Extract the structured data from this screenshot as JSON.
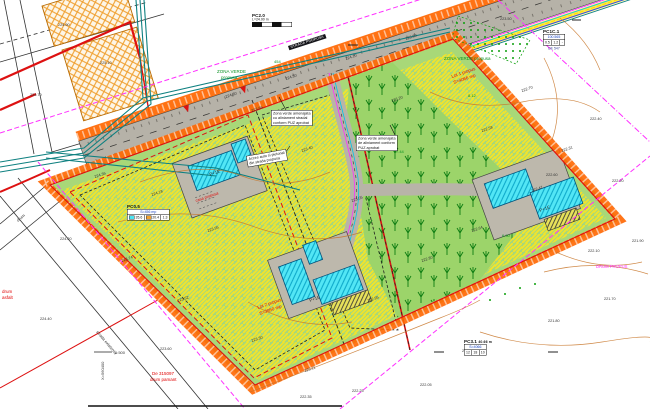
{
  "title": "Plan de situatie - propunere",
  "colors": {
    "red": "#e00000",
    "grn": "#089020",
    "blk": "#333333",
    "mag": "#ff30ff",
    "boundary_band": "#ff6600",
    "red_line": "#dd1111",
    "parcel_green": "#a8d878",
    "hatch_yellow": "#f2e42a",
    "building_cyan": "#52e6f5",
    "pad_gray": "#bdb8ac",
    "road_gray": "#b6b2a8",
    "existing_hatch": "#f0a030",
    "utility_teal": "#0e8080",
    "contour": "#c8762a",
    "tree_green": "#0e7d12"
  },
  "scale_tables": {
    "pc2": {
      "title": "PC2.0",
      "sub": "L=24.00 m"
    },
    "pc1c": {
      "title": "PC1C.1",
      "header": "100.565",
      "cells": [
        "0.5",
        "1.2",
        "-"
      ],
      "note": "DE 547"
    },
    "pc05": {
      "title": "PC0.5",
      "header": "S=456 mp",
      "cells": [
        "35.6",
        "20.4",
        "1.3"
      ]
    },
    "pc3": {
      "title": "PC3.1",
      "sub": "40.66 m",
      "header": "S=4066",
      "cells": [
        "12",
        "18",
        "10"
      ]
    }
  },
  "annotation_boxes": {
    "b1": {
      "lines": [
        "Zona verde amenajata",
        "cu aliniament stradal",
        "conform PUZ aprobat"
      ]
    },
    "b2": {
      "lines": [
        "Acces auto si pietonal",
        "din strada propusa"
      ]
    },
    "b3": {
      "lines": [
        "Zona verde amenajata",
        "de aliniament conform",
        "PUZ aprobat"
      ]
    },
    "street_tag": "STRADA PROPUSA"
  },
  "labels": [
    {
      "t": "Lot 1 propus",
      "x": 452,
      "y": 78,
      "c": "red",
      "r": -19
    },
    {
      "t": "S=4066 mp",
      "x": 454,
      "y": 84,
      "c": "red",
      "r": -19
    },
    {
      "t": "Lot 2 propus",
      "x": 258,
      "y": 309,
      "c": "red",
      "r": -19
    },
    {
      "t": "S=3950 mp",
      "x": 260,
      "y": 315,
      "c": "red",
      "r": -19
    },
    {
      "t": "casa propusa",
      "x": 196,
      "y": 202,
      "c": "red",
      "r": -19,
      "s": 4
    },
    {
      "t": "De 315097",
      "x": 152,
      "y": 375,
      "c": "red"
    },
    {
      "t": "drum pamant",
      "x": 150,
      "y": 381,
      "c": "red"
    },
    {
      "t": "drum",
      "x": 2,
      "y": 293,
      "c": "red"
    },
    {
      "t": "asfalt",
      "x": 2,
      "y": 299,
      "c": "red"
    },
    {
      "t": "DRUM PROPUS",
      "x": 596,
      "y": 268,
      "c": "mag",
      "s": 4.2
    },
    {
      "t": "ZONA VERDE",
      "x": 217,
      "y": 73,
      "c": "grn"
    },
    {
      "t": "propusa",
      "x": 221,
      "y": 79,
      "c": "grn"
    },
    {
      "t": "ZONA VERDE propusa",
      "x": 444,
      "y": 60,
      "c": "grn"
    },
    {
      "t": "454",
      "x": 274,
      "y": 63,
      "c": "grn",
      "s": 4
    },
    {
      "t": "7.44",
      "x": 396,
      "y": 153,
      "c": "grn",
      "s": 4
    },
    {
      "t": "8.12",
      "x": 468,
      "y": 97,
      "c": "grn",
      "s": 4
    },
    {
      "t": "6.90",
      "x": 502,
      "y": 237,
      "c": "grn",
      "s": 4
    },
    {
      "t": "P+1E",
      "x": 210,
      "y": 176,
      "c": "blk",
      "r": -20
    },
    {
      "t": "P+1E",
      "x": 310,
      "y": 302,
      "c": "blk",
      "r": -20
    },
    {
      "t": "P+1E",
      "x": 540,
      "y": 212,
      "c": "blk",
      "r": -20
    },
    {
      "t": "strada existenta",
      "x": 96,
      "y": 332,
      "c": "blk",
      "r": 50,
      "s": 4.2
    },
    {
      "t": "drum",
      "x": 18,
      "y": 222,
      "c": "blk",
      "r": -40,
      "s": 4.2
    },
    {
      "t": "X=560400",
      "x": 104,
      "y": 380,
      "c": "blk",
      "r": -90,
      "s": 4
    },
    {
      "t": "1:500",
      "x": 115,
      "y": 354,
      "c": "blk",
      "s": 4
    },
    {
      "t": "224.36",
      "x": 95,
      "y": 178,
      "c": "blk",
      "s": 3.8,
      "r": -19
    },
    {
      "t": "224.18",
      "x": 152,
      "y": 196,
      "c": "blk",
      "s": 3.8,
      "r": -19
    },
    {
      "t": "223.95",
      "x": 208,
      "y": 232,
      "c": "blk",
      "s": 3.8,
      "r": -19
    },
    {
      "t": "223.74",
      "x": 122,
      "y": 262,
      "c": "blk",
      "s": 3.8,
      "r": -19
    },
    {
      "t": "223.52",
      "x": 178,
      "y": 302,
      "c": "blk",
      "s": 3.8,
      "r": -19
    },
    {
      "t": "223.30",
      "x": 252,
      "y": 342,
      "c": "blk",
      "s": 3.8,
      "r": -19
    },
    {
      "t": "223.11",
      "x": 305,
      "y": 372,
      "c": "blk",
      "s": 3.8,
      "r": -19
    },
    {
      "t": "222.95",
      "x": 368,
      "y": 302,
      "c": "blk",
      "s": 3.8,
      "r": -19
    },
    {
      "t": "222.80",
      "x": 422,
      "y": 262,
      "c": "blk",
      "s": 3.8,
      "r": -19
    },
    {
      "t": "222.64",
      "x": 472,
      "y": 232,
      "c": "blk",
      "s": 3.8,
      "r": -19
    },
    {
      "t": "222.47",
      "x": 532,
      "y": 192,
      "c": "blk",
      "s": 3.8,
      "r": -19
    },
    {
      "t": "222.31",
      "x": 562,
      "y": 152,
      "c": "blk",
      "s": 3.8,
      "r": -19
    },
    {
      "t": "222.58",
      "x": 482,
      "y": 132,
      "c": "blk",
      "s": 3.8,
      "r": -19
    },
    {
      "t": "223.05",
      "x": 352,
      "y": 202,
      "c": "blk",
      "s": 3.8,
      "r": -19
    },
    {
      "t": "223.40",
      "x": 302,
      "y": 152,
      "c": "blk",
      "s": 3.8,
      "r": -19
    },
    {
      "t": "223.66",
      "x": 252,
      "y": 112,
      "c": "blk",
      "s": 3.8,
      "r": -19
    },
    {
      "t": "223.20",
      "x": 392,
      "y": 102,
      "c": "blk",
      "s": 3.8,
      "r": -19
    },
    {
      "t": "222.70",
      "x": 522,
      "y": 92,
      "c": "blk",
      "s": 3.8,
      "r": -19
    },
    {
      "t": "222.10",
      "x": 588,
      "y": 252,
      "c": "blk",
      "s": 3.8
    },
    {
      "t": "221.95",
      "x": 462,
      "y": 352,
      "c": "blk",
      "s": 3.8
    },
    {
      "t": "222.25",
      "x": 352,
      "y": 392,
      "c": "blk",
      "s": 3.8
    },
    {
      "t": "221.80",
      "x": 548,
      "y": 322,
      "c": "blk",
      "s": 3.8
    },
    {
      "t": "222.20",
      "x": 612,
      "y": 182,
      "c": "blk",
      "s": 3.8
    },
    {
      "t": "221.90",
      "x": 632,
      "y": 242,
      "c": "blk",
      "s": 3.8
    },
    {
      "t": "222.40",
      "x": 590,
      "y": 120,
      "c": "blk",
      "s": 3.8
    },
    {
      "t": "222.60",
      "x": 546,
      "y": 176,
      "c": "blk",
      "s": 3.8
    },
    {
      "t": "224.90",
      "x": 58,
      "y": 26,
      "c": "blk",
      "s": 3.8
    },
    {
      "t": "225.10",
      "x": 100,
      "y": 64,
      "c": "blk",
      "s": 3.8
    },
    {
      "t": "224.70",
      "x": 30,
      "y": 96,
      "c": "blk",
      "s": 3.8
    },
    {
      "t": "224.80",
      "x": 226,
      "y": 98,
      "c": "blk",
      "s": 3.8,
      "r": -19
    },
    {
      "t": "224.50",
      "x": 286,
      "y": 80,
      "c": "blk",
      "s": 3.8,
      "r": -19
    },
    {
      "t": "224.10",
      "x": 346,
      "y": 60,
      "c": "blk",
      "s": 3.8,
      "r": -19
    },
    {
      "t": "223.80",
      "x": 406,
      "y": 40,
      "c": "blk",
      "s": 3.8,
      "r": -19
    },
    {
      "t": "223.50",
      "x": 500,
      "y": 20,
      "c": "blk",
      "s": 3.8
    },
    {
      "t": "221.70",
      "x": 604,
      "y": 300,
      "c": "blk",
      "s": 3.8
    },
    {
      "t": "222.05",
      "x": 420,
      "y": 386,
      "c": "blk",
      "s": 3.8
    },
    {
      "t": "222.35",
      "x": 300,
      "y": 398,
      "c": "blk",
      "s": 3.8
    },
    {
      "t": "223.60",
      "x": 160,
      "y": 350,
      "c": "blk",
      "s": 3.8
    },
    {
      "t": "224.20",
      "x": 60,
      "y": 240,
      "c": "blk",
      "s": 3.8
    },
    {
      "t": "224.40",
      "x": 40,
      "y": 320,
      "c": "blk",
      "s": 3.8
    }
  ]
}
